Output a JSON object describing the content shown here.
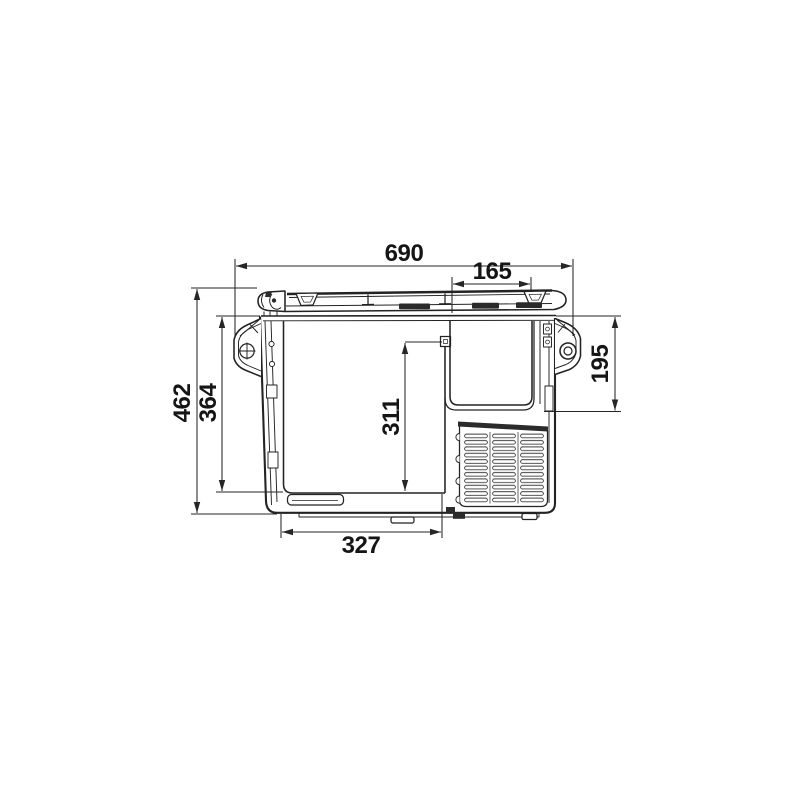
{
  "diagram": {
    "kind": "technical-dimension-drawing",
    "subject": "portable compressor cooler, front elevation",
    "units": "mm",
    "dims": {
      "overall_width": "690",
      "recess_width": "165",
      "overall_height": "462",
      "body_height": "364",
      "door_height": "311",
      "recess_depth": "195",
      "base_width": "327"
    },
    "icons": {
      "left_handle_screw": "crosshair-circle",
      "right_handle_hole": "ring"
    },
    "colors": {
      "line": "#232323",
      "dimension": "#262626",
      "text": "#151515",
      "background": "#ffffff",
      "dark_fill": "#2b2b2b"
    }
  }
}
